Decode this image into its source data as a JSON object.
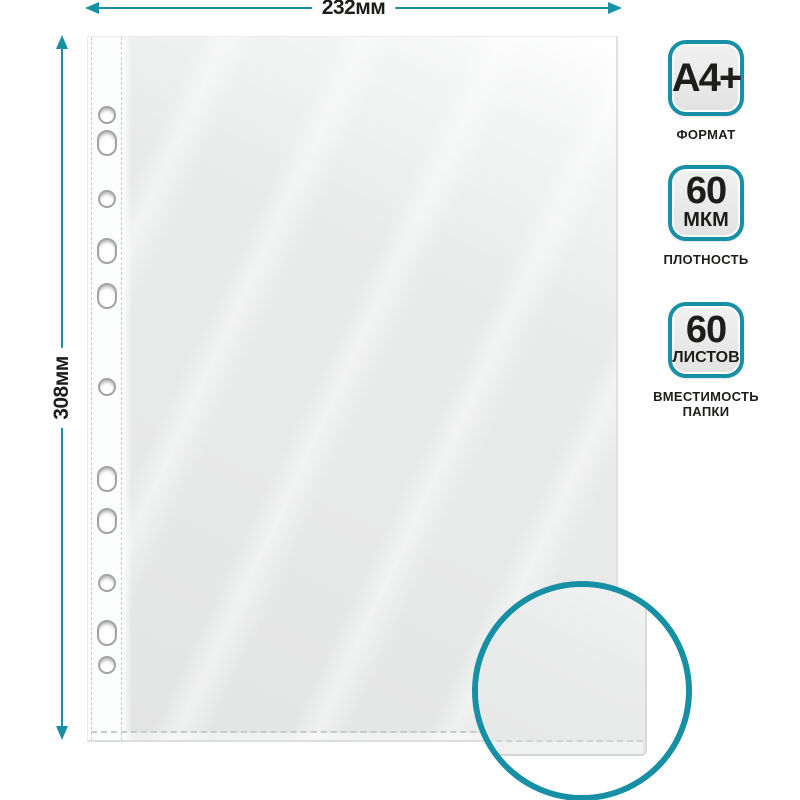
{
  "accent_color": "#1790a5",
  "dimensions": {
    "width_label": "232мм",
    "height_label": "308мм"
  },
  "badges": [
    {
      "value": "A4+",
      "unit": "",
      "label": "ФОРМАТ"
    },
    {
      "value": "60",
      "unit": "МКМ",
      "label": "ПЛОТНОСТЬ"
    },
    {
      "value": "60",
      "unit": "ЛИСТОВ",
      "label": "ВМЕСТИМОСТЬ ПАПКИ"
    }
  ],
  "sheet": {
    "holes": [
      {
        "y": 114,
        "shape": "round"
      },
      {
        "y": 142,
        "shape": "oval"
      },
      {
        "y": 198,
        "shape": "round"
      },
      {
        "y": 250,
        "shape": "oval"
      },
      {
        "y": 295,
        "shape": "oval"
      },
      {
        "y": 386,
        "shape": "round"
      },
      {
        "y": 478,
        "shape": "oval"
      },
      {
        "y": 520,
        "shape": "oval"
      },
      {
        "y": 582,
        "shape": "round"
      },
      {
        "y": 632,
        "shape": "oval"
      },
      {
        "y": 664,
        "shape": "round"
      }
    ]
  }
}
